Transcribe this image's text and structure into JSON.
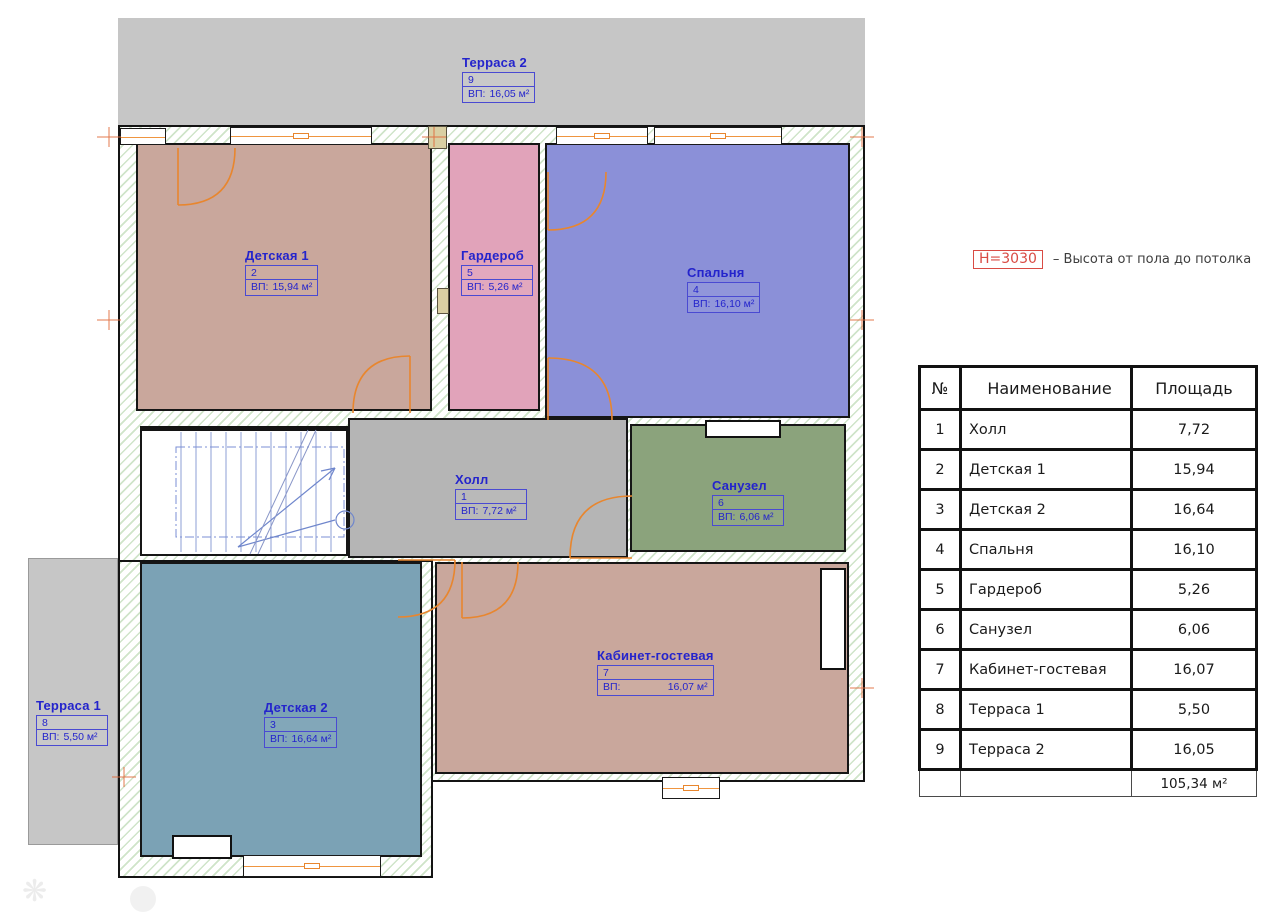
{
  "legend": {
    "height_label": "H=3030",
    "height_desc": "– Высота от пола до потолка"
  },
  "rooms": [
    {
      "name": "Терраса 2",
      "num": "9",
      "area_prefix": "ВП:",
      "area_value": "16,05 м²"
    },
    {
      "name": "Детская 1",
      "num": "2",
      "area_prefix": "ВП:",
      "area_value": "15,94 м²"
    },
    {
      "name": "Гардероб",
      "num": "5",
      "area_prefix": "ВП:",
      "area_value": "5,26 м²"
    },
    {
      "name": "Спальня",
      "num": "4",
      "area_prefix": "ВП:",
      "area_value": "16,10 м²"
    },
    {
      "name": "Холл",
      "num": "1",
      "area_prefix": "ВП:",
      "area_value": "7,72 м²"
    },
    {
      "name": "Санузел",
      "num": "6",
      "area_prefix": "ВП:",
      "area_value": "6,06 м²"
    },
    {
      "name": "Детская 2",
      "num": "3",
      "area_prefix": "ВП:",
      "area_value": "16,64 м²"
    },
    {
      "name": "Кабинет-гостевая",
      "num": "7",
      "area_prefix": "ВП:",
      "area_value": "16,07 м²"
    },
    {
      "name": "Терраса 1",
      "num": "8",
      "area_prefix": "ВП:",
      "area_value": "5,50 м²"
    }
  ],
  "table": {
    "headers": [
      "№",
      "Наименование",
      "Площадь"
    ],
    "rows": [
      [
        "1",
        "Холл",
        "7,72"
      ],
      [
        "2",
        "Детская 1",
        "15,94"
      ],
      [
        "3",
        "Детская 2",
        "16,64"
      ],
      [
        "4",
        "Спальня",
        "16,10"
      ],
      [
        "5",
        "Гардероб",
        "5,26"
      ],
      [
        "6",
        "Санузел",
        "6,06"
      ],
      [
        "7",
        "Кабинет-гостевая",
        "16,07"
      ],
      [
        "8",
        "Терраса 1",
        "5,50"
      ],
      [
        "9",
        "Терраса 2",
        "16,05"
      ]
    ],
    "total": "105,34 м²"
  },
  "colors": {
    "room_children1": "#c9a79c",
    "room_wardrobe": "#e1a3ba",
    "room_bedroom": "#8b90d8",
    "room_hall": "#b5b5b5",
    "room_bath": "#8ba37c",
    "room_children2": "#7ba2b5",
    "room_office": "#c9a79c",
    "terrace": "#c6c6c6",
    "label_blue": "#2424cc",
    "door_orange": "#e8862e",
    "legend_red": "#d94b44",
    "wall": "#141414"
  }
}
